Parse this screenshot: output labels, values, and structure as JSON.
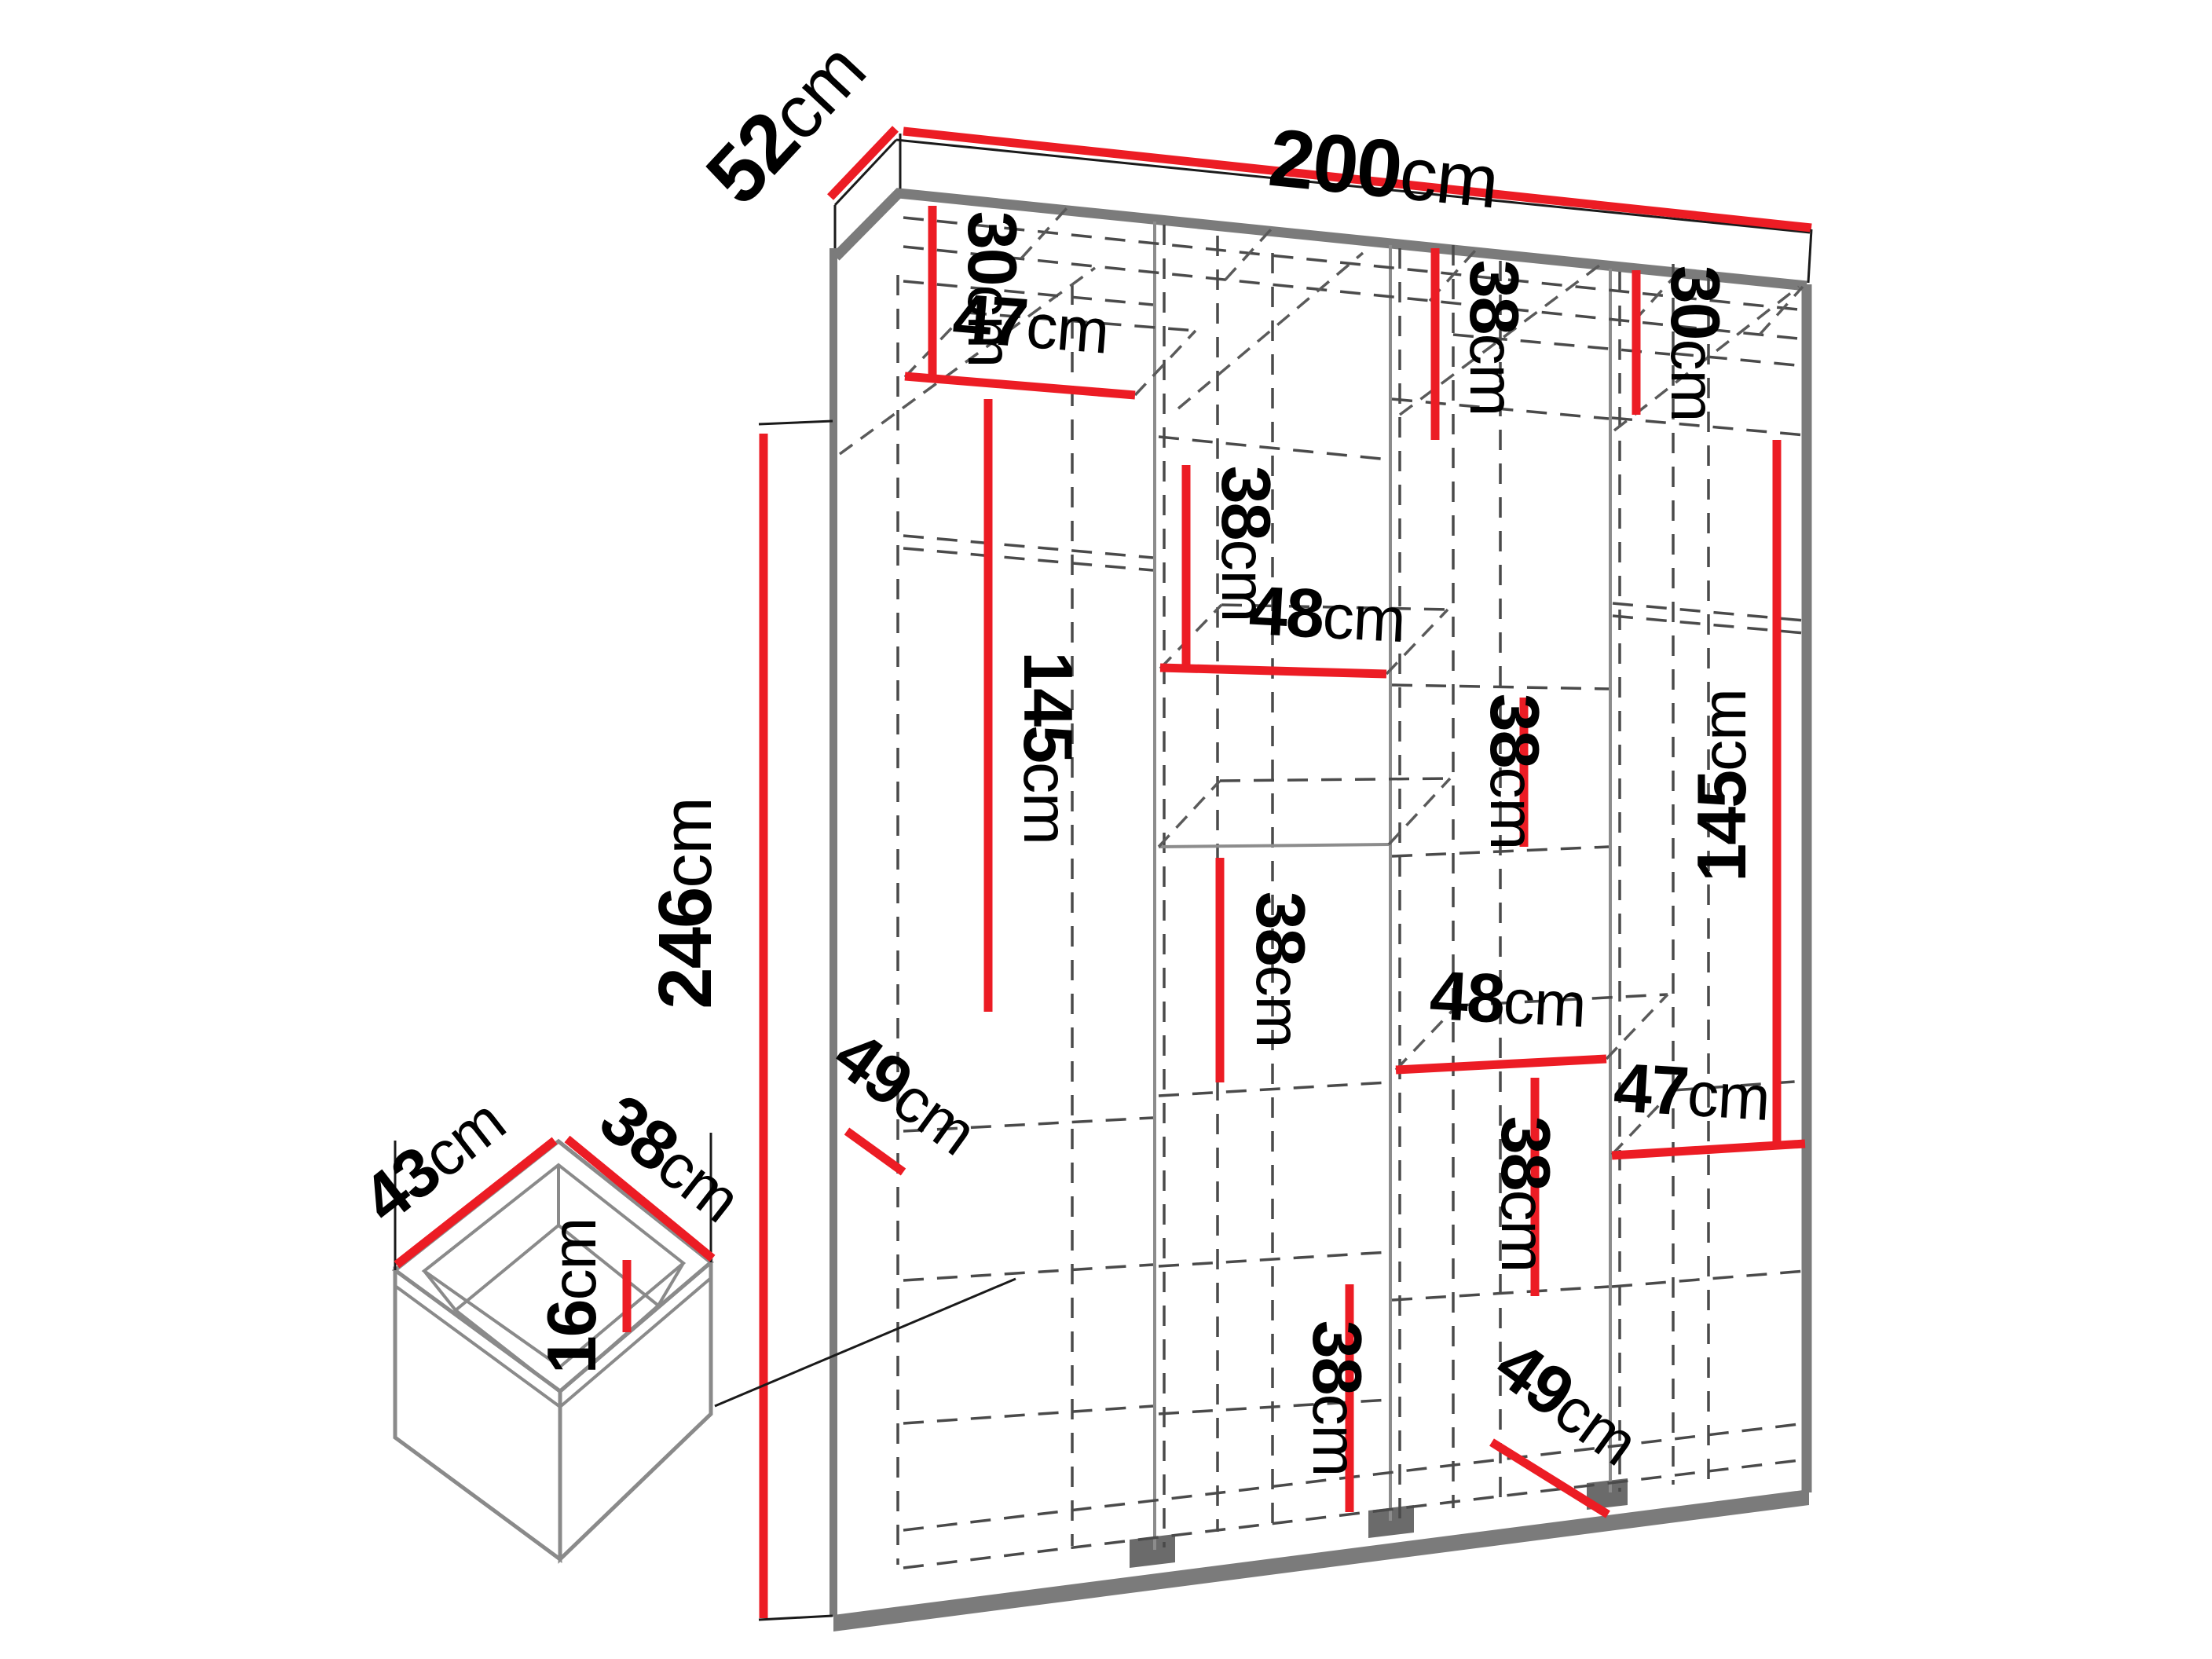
{
  "colors": {
    "dimension_red": "#EC1C24",
    "structure_gray": "#7B7B7B",
    "dashed_line": "#4A4A4A",
    "label_text": "#000000"
  },
  "wardrobe": {
    "width": {
      "num": "200",
      "unit": "cm"
    },
    "depth": {
      "num": "52",
      "unit": "cm"
    },
    "height": {
      "num": "246",
      "unit": "cm"
    },
    "col1": {
      "top": {
        "num": "30",
        "unit": "cm"
      },
      "shelf": {
        "num": "47",
        "unit": "cm"
      },
      "hanging": {
        "num": "145",
        "unit": "cm"
      },
      "bottom_depth": {
        "num": "49",
        "unit": "cm"
      }
    },
    "col2": {
      "upper": {
        "num": "38",
        "unit": "cm"
      },
      "shelf": {
        "num": "48",
        "unit": "cm"
      },
      "middle": {
        "num": "38",
        "unit": "cm"
      },
      "lower": {
        "num": "38",
        "unit": "cm"
      }
    },
    "col3": {
      "top": {
        "num": "38",
        "unit": "cm"
      },
      "upper": {
        "num": "38",
        "unit": "cm"
      },
      "shelf": {
        "num": "48",
        "unit": "cm"
      },
      "lower": {
        "num": "38",
        "unit": "cm"
      },
      "bottom_depth": {
        "num": "49",
        "unit": "cm"
      }
    },
    "col4": {
      "top": {
        "num": "30",
        "unit": "cm"
      },
      "hanging": {
        "num": "145",
        "unit": "cm"
      },
      "shelf": {
        "num": "47",
        "unit": "cm"
      }
    }
  },
  "drawer": {
    "width": {
      "num": "43",
      "unit": "cm"
    },
    "depth": {
      "num": "38",
      "unit": "cm"
    },
    "height": {
      "num": "16",
      "unit": "cm"
    }
  }
}
